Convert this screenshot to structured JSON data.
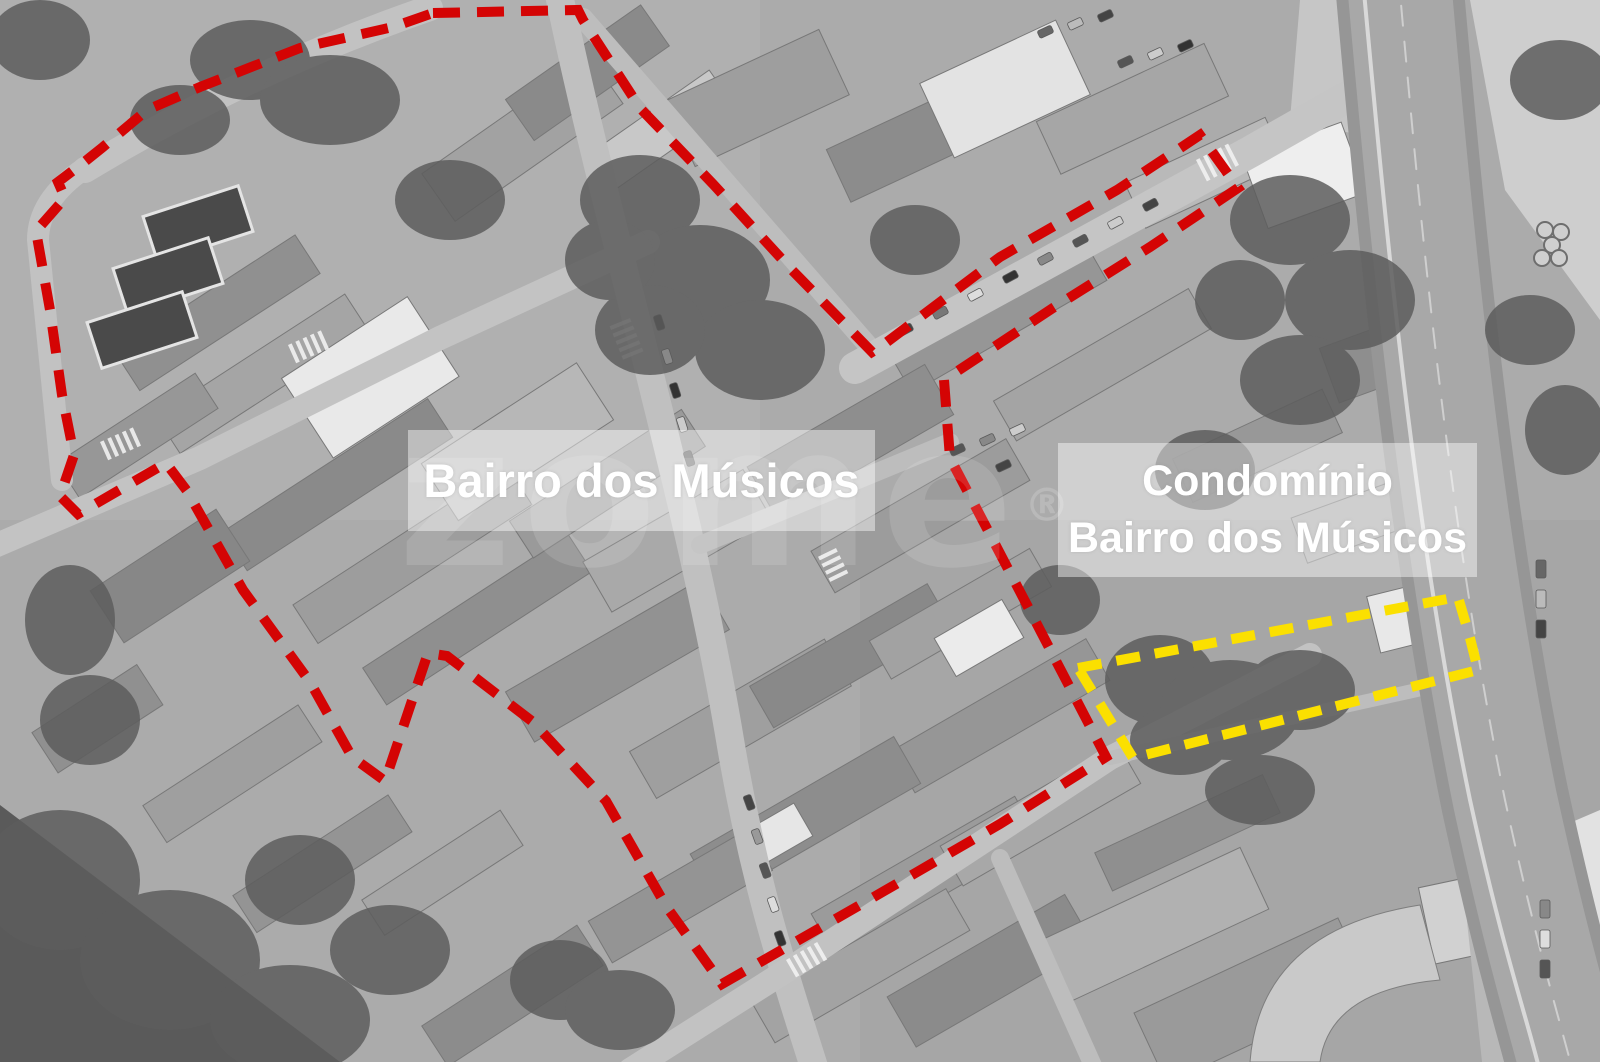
{
  "map": {
    "region_labels": {
      "bairro": {
        "text": "Bairro dos Músicos"
      },
      "condominio": {
        "line1": "Condomínio",
        "line2": "Bairro dos Músicos"
      }
    },
    "watermark": {
      "brand": "zome",
      "registered_mark": "®"
    },
    "annotations": {
      "red_boundary": {
        "label": "Bairro dos Músicos perimeter",
        "color": "#d40404",
        "stroke_width": 10,
        "dash": [
          27,
          17
        ],
        "points": [
          [
            433,
            13
          ],
          [
            578,
            10
          ],
          [
            583,
            20
          ],
          [
            640,
            108
          ],
          [
            713,
            184
          ],
          [
            790,
            268
          ],
          [
            872,
            352
          ],
          [
            883,
            345
          ],
          [
            1000,
            257
          ],
          [
            1117,
            190
          ],
          [
            1200,
            135
          ],
          [
            1238,
            188
          ],
          [
            1150,
            247
          ],
          [
            1053,
            308
          ],
          [
            944,
            380
          ],
          [
            950,
            458
          ],
          [
            1028,
            607
          ],
          [
            1106,
            757
          ],
          [
            1000,
            824
          ],
          [
            860,
            905
          ],
          [
            722,
            984
          ],
          [
            666,
            906
          ],
          [
            606,
            801
          ],
          [
            533,
            722
          ],
          [
            447,
            656
          ],
          [
            428,
            653
          ],
          [
            385,
            781
          ],
          [
            352,
            757
          ],
          [
            310,
            682
          ],
          [
            243,
            590
          ],
          [
            187,
            491
          ],
          [
            166,
            463
          ],
          [
            78,
            514
          ],
          [
            60,
            496
          ],
          [
            74,
            455
          ],
          [
            62,
            395
          ],
          [
            50,
            310
          ],
          [
            36,
            231
          ],
          [
            65,
            198
          ],
          [
            58,
            182
          ],
          [
            83,
            163
          ],
          [
            103,
            147
          ],
          [
            147,
            110
          ],
          [
            200,
            87
          ],
          [
            300,
            48
          ],
          [
            393,
            27
          ]
        ]
      },
      "yellow_boundary": {
        "label": "Condomínio Bairro dos Músicos parcel",
        "color": "#fbe000",
        "stroke_width": 10,
        "dash": [
          24,
          15
        ],
        "points": [
          [
            1078,
            668
          ],
          [
            1458,
            597
          ],
          [
            1470,
            638
          ],
          [
            1478,
            670
          ],
          [
            1133,
            758
          ]
        ]
      }
    }
  }
}
